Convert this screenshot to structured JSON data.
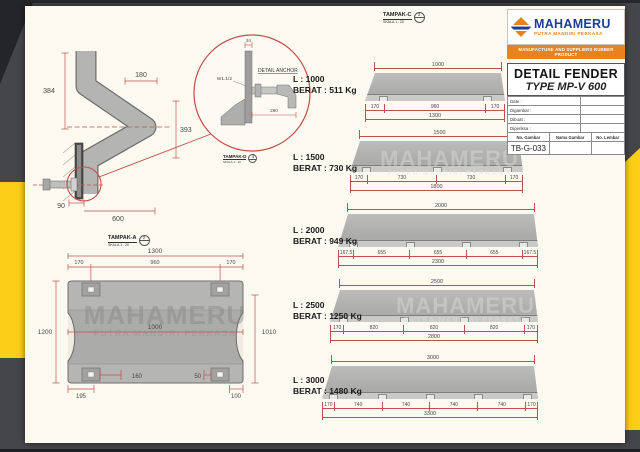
{
  "colors": {
    "accent_yellow": "#fbce17",
    "frame_gray": "#45464a",
    "dim_red": "#c0504d",
    "brand_blue": "#1c3e96",
    "brand_orange": "#e8821f"
  },
  "watermark": {
    "line1": "MAHAMERU",
    "line2": "PUTRA MANDIRI PERKASA"
  },
  "title_block": {
    "brand": "MAHAMERU",
    "brand_sub": "PUTRA MANDIRI PERKASA",
    "banner": "MANUFACTURE AND SUPPLIERS RUBBER PRODUCT",
    "title_line1": "DETAIL FENDER",
    "title_line2": "TYPE MP-V 600",
    "info_rows": [
      {
        "label": "Date :"
      },
      {
        "label": "Digambar :"
      },
      {
        "label": "Dibuat :"
      },
      {
        "label": "Diperiksa :"
      }
    ],
    "footer_headers": [
      "No. Gambar",
      "Nama Gambar",
      "No. Lembar"
    ],
    "drawing_number": "TB-G-033"
  },
  "section_view": {
    "dim_left_height": "384",
    "dim_top_width": "180",
    "dim_right_height": "393",
    "dim_base": "90",
    "dim_bottom_width": "600",
    "label": "TAMPAK-A",
    "scale": "SKALA 1 : 20",
    "ref": "2"
  },
  "detail_view": {
    "title": "DETAIL ANCHOR",
    "dim_top": "34",
    "thread_label": "W1.1/2",
    "dim_length": "290",
    "label": "TAMPAK-D",
    "scale": "SKALA 1 : 10",
    "ref": "4"
  },
  "front_view": {
    "dim_total_width": "1300",
    "dim_edge_left": "170",
    "dim_center": "960",
    "dim_edge_right": "170",
    "dim_height_left": "1200",
    "dim_height_right": "1010",
    "dim_inner": "1000",
    "dim_anchor_left": "160",
    "dim_anchor_right": "50",
    "dim_bottom_left": "195",
    "dim_bottom_right": "100"
  },
  "side_views": {
    "label": "TAMPAK-C",
    "scale": "SKALA 1 : 20",
    "ref": "3",
    "fenders": [
      {
        "length_label": "L : 1000",
        "weight_label": "BERAT : 511 Kg",
        "top_dim": "1000",
        "segments": [
          "170",
          "960",
          "170"
        ],
        "total_dim": "1300"
      },
      {
        "length_label": "L : 1500",
        "weight_label": "BERAT : 730 Kg",
        "top_dim": "1500",
        "segments": [
          "170",
          "730",
          "730",
          "170"
        ],
        "total_dim": "1800"
      },
      {
        "length_label": "L : 2000",
        "weight_label": "BERAT : 949 Kg",
        "top_dim": "2000",
        "segments": [
          "167.5",
          "655",
          "655",
          "655",
          "167.5"
        ],
        "total_dim": "2300"
      },
      {
        "length_label": "L : 2500",
        "weight_label": "BERAT : 1250 Kg",
        "top_dim": "2500",
        "segments": [
          "170",
          "820",
          "820",
          "820",
          "170"
        ],
        "total_dim": "2800"
      },
      {
        "length_label": "L : 3000",
        "weight_label": "BERAT : 1480 Kg",
        "top_dim": "3000",
        "segments": [
          "170",
          "740",
          "740",
          "740",
          "740",
          "170"
        ],
        "total_dim": "3300"
      }
    ]
  }
}
